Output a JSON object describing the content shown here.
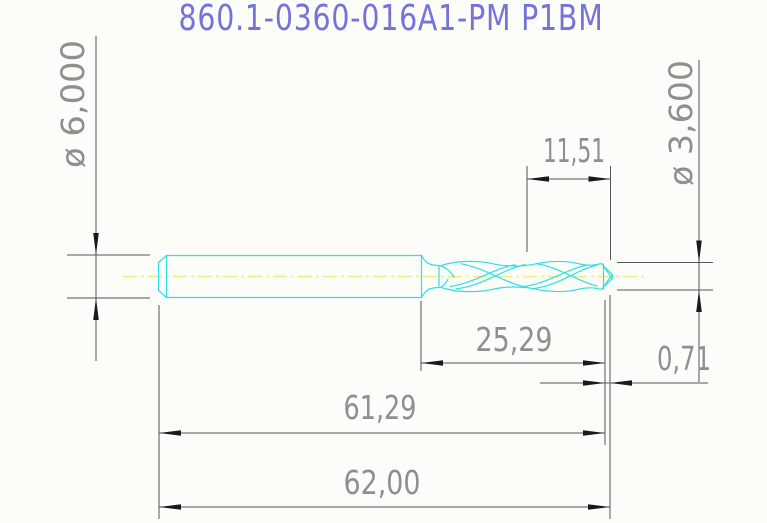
{
  "title": "860.1-0360-016A1-PM P1BM",
  "drawing": {
    "kind": "cad-drill-tool-drawing",
    "dimensions": {
      "shank_diameter": "ø 6,000",
      "cutting_diameter": "ø 3,600",
      "point_section_length": "11,51",
      "flute_to_shoulder_length": "25,29",
      "tip_length": "0,71",
      "length_to_flute_end": "61,29",
      "overall_length": "62,00"
    }
  },
  "colors": {
    "bg": "#fcfcf9",
    "outline": "#2ee0e6",
    "centerline": "#f0ec85",
    "title": "#7373d9",
    "dim_text": "#8f8f8f",
    "dim_line": "#555555",
    "arrow": "#1a1a1a"
  }
}
